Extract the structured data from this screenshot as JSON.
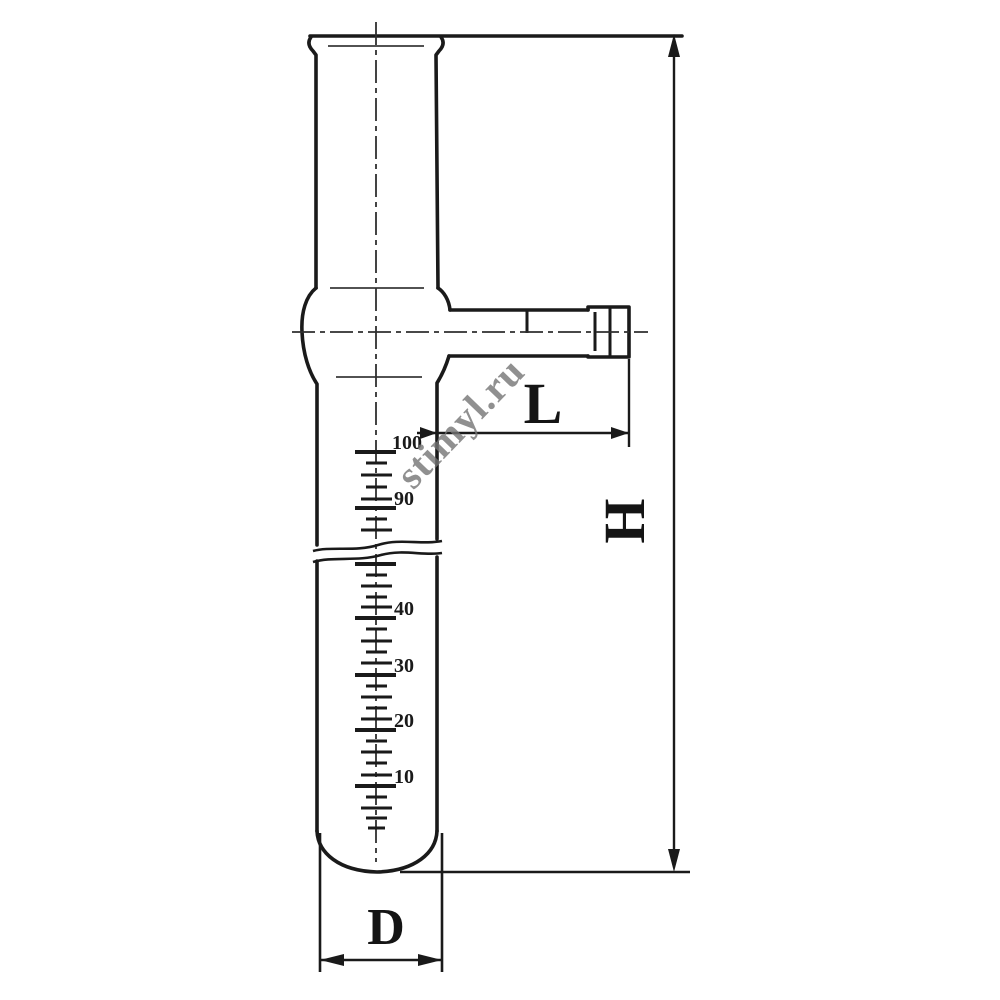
{
  "drawing": {
    "colors": {
      "line": "#1a1a1a",
      "background": "#ffffff",
      "watermark": "#757575"
    },
    "dimension_labels": {
      "height": "H",
      "arm_length": "L",
      "diameter": "D"
    },
    "scale_labels": [
      "100",
      "90",
      "40",
      "30",
      "20",
      "10"
    ],
    "watermark": {
      "text": "stimyl.ru"
    }
  }
}
